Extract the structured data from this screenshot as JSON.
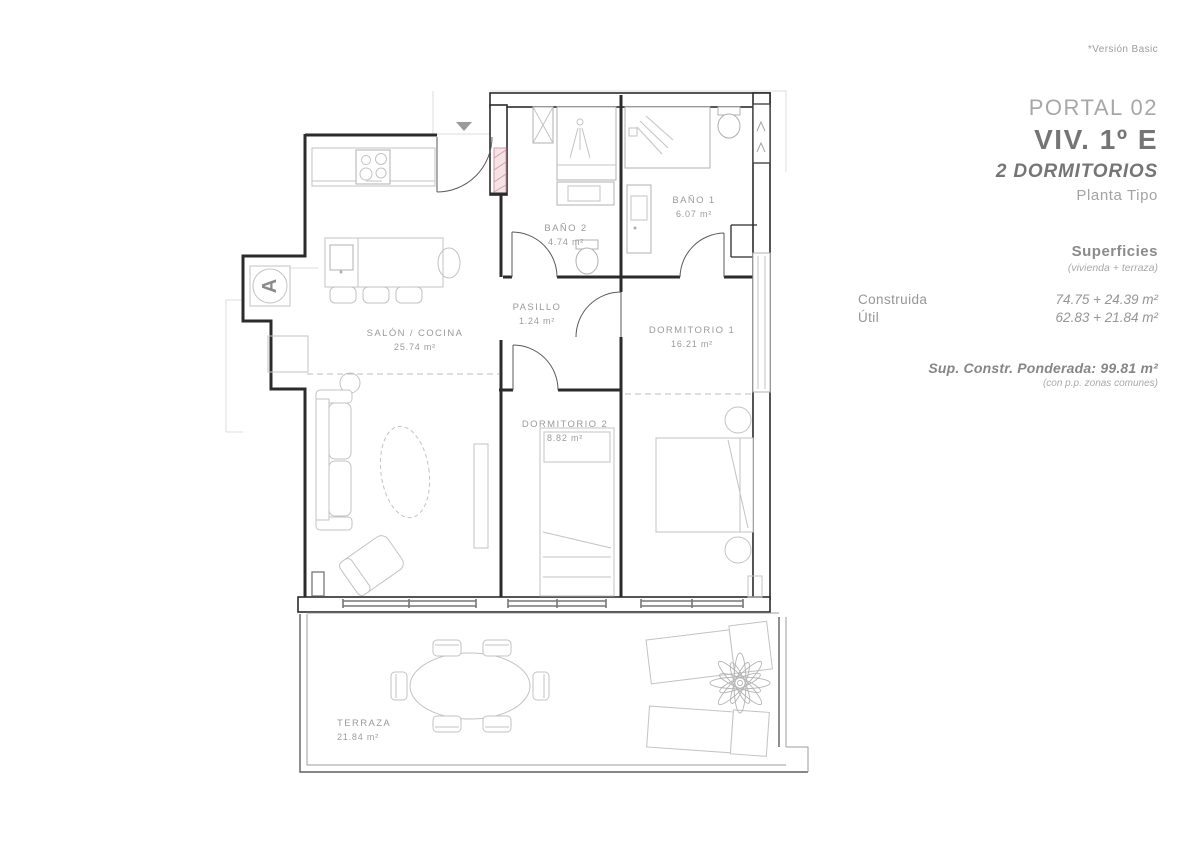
{
  "version_note": "*Versión Basic",
  "header": {
    "portal": "PORTAL 02",
    "unit": "VIV. 1º E",
    "type": "2 DORMITORIOS",
    "plan": "Planta Tipo"
  },
  "superficies": {
    "title": "Superficies",
    "subtitle": "(vivienda + terraza)",
    "rows": [
      {
        "label": "Construida",
        "value": "74.75 + 24.39 m²"
      },
      {
        "label": "Útil",
        "value": "62.83 + 21.84 m²"
      }
    ],
    "ponderada": "Sup. Constr. Ponderada: 99.81 m²",
    "ponderada_note": "(con p.p. zonas comunes)"
  },
  "plan": {
    "access_marker": "A",
    "rooms": [
      {
        "name": "SALÓN / COCINA",
        "area": "25.74 m²"
      },
      {
        "name": "BAÑO 2",
        "area": "4.74 m²"
      },
      {
        "name": "BAÑO 1",
        "area": "6.07 m²"
      },
      {
        "name": "PASILLO",
        "area": "1.24 m²"
      },
      {
        "name": "DORMITORIO 1",
        "area": "16.21 m²"
      },
      {
        "name": "DORMITORIO 2",
        "area": "8.82 m²"
      },
      {
        "name": "TERRAZA",
        "area": "21.84 m²"
      }
    ]
  },
  "colors": {
    "wall": "#2b2b2b",
    "furniture": "#c3c3c3",
    "label": "#9b9b9b",
    "shaft_fill": "#f6e3e6",
    "shaft_line": "#cf9ea8"
  }
}
